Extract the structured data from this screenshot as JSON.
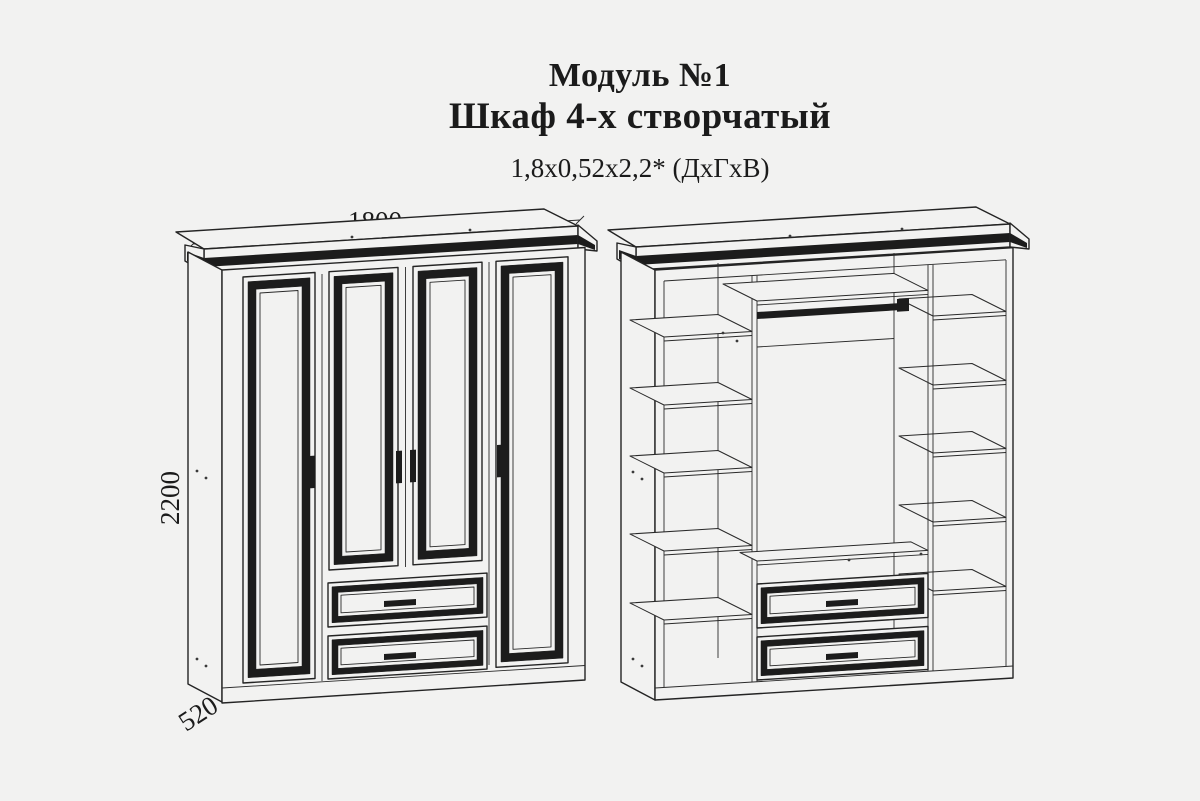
{
  "canvas": {
    "background": "#f2f2f1",
    "line_color": "#242424",
    "accent_black": "#1c1c1c"
  },
  "header": {
    "module_title": "Модуль №1",
    "product_title": "Шкаф 4-х створчатый",
    "overall_size": "1,8х0,52х2,2* (ДхГхВ)"
  },
  "front_view": {
    "width_label": "1800",
    "height_label": "2200",
    "depth_label": "520"
  }
}
